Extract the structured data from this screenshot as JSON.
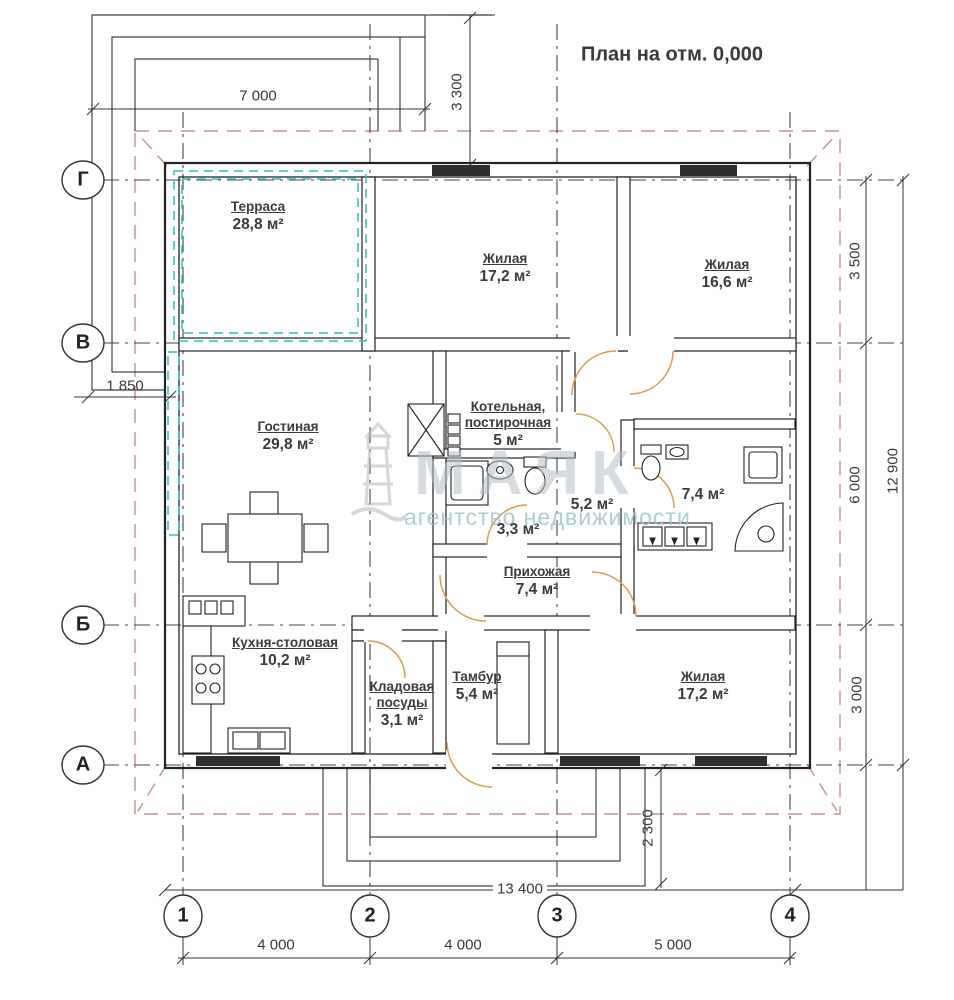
{
  "title": "План на отм. 0,000",
  "watermark": {
    "brand": "МАЯК",
    "tagline": "агентство недвижимости"
  },
  "axes": {
    "rows": [
      "Г",
      "В",
      "Б",
      "А"
    ],
    "cols": [
      "1",
      "2",
      "3",
      "4"
    ]
  },
  "rooms": {
    "terrace": {
      "name": "Терраса",
      "area": "28,8 м²"
    },
    "living_top": {
      "name": "Жилая",
      "area": "17,2 м²"
    },
    "living_topright": {
      "name": "Жилая",
      "area": "16,6 м²"
    },
    "livingroom": {
      "name": "Гостиная",
      "area": "29,8 м²"
    },
    "boiler": {
      "name": "Котельная, постирочная",
      "area": "5 м²"
    },
    "shower": {
      "area": "3,3 м²"
    },
    "hall_small": {
      "area": "5,2 м²"
    },
    "bathroom": {
      "area": "7,4 м²"
    },
    "hallway": {
      "name": "Прихожая",
      "area": "7,4 м²"
    },
    "kitchen": {
      "name": "Кухня-столовая",
      "area": "10,2 м²"
    },
    "pantry": {
      "name": "Кладовая посуды",
      "area": "3,1 м²"
    },
    "vestibule": {
      "name": "Тамбур",
      "area": "5,4 м²"
    },
    "living_bottom": {
      "name": "Жилая",
      "area": "17,2 м²"
    }
  },
  "dims": {
    "w7000": "7 000",
    "v3300": "3 300",
    "l1850": "1 850",
    "r3500": "3 500",
    "r6000": "6 000",
    "r3000": "3 000",
    "r12900": "12 900",
    "v2300": "2 300",
    "w13400": "13 400",
    "s1": "4 000",
    "s2": "4 000",
    "s3": "5 000"
  },
  "colors": {
    "terrace_teal": "#2fbdbd",
    "roof_pink": "#c98f8f",
    "door_orange": "#e09a50",
    "line_dark": "#222222"
  }
}
